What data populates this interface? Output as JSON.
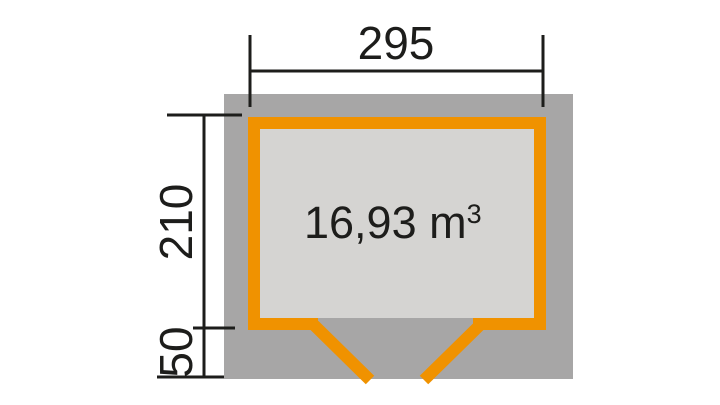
{
  "colors": {
    "background": "#ffffff",
    "roof_area": "#a7a6a6",
    "floor_area": "#d5d4d2",
    "wall": "#f09200",
    "ink": "#1d1d1b"
  },
  "dimensions": {
    "width_label": "295",
    "depth_label": "210",
    "overhang_label": "50"
  },
  "volume": {
    "value": "16,93 m",
    "exponent": "3",
    "display": "16,93 m³"
  }
}
